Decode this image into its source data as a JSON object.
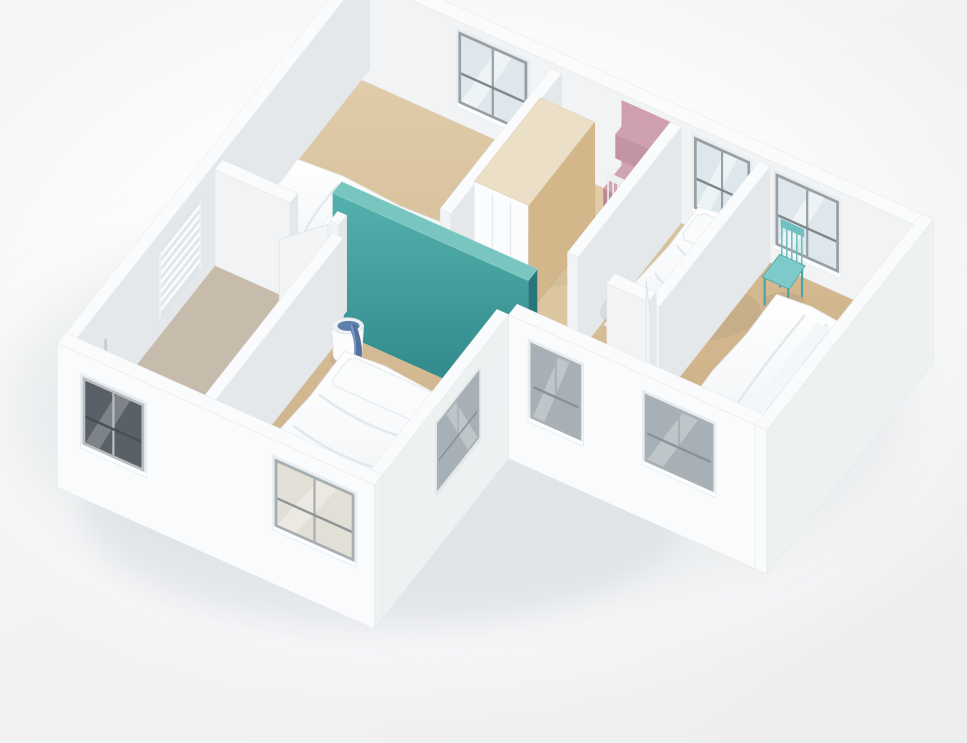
{
  "palette": {
    "background": "#f2f3f5",
    "wallTop": "#fafbfc",
    "wallFace": "#f1f3f5",
    "wallSide": "#e4e8ea",
    "wallExtFace": "#fafbfc",
    "wallExtSide": "#eef1f2",
    "wood": "#d5bb93",
    "woodDark": "#c7aa80",
    "bathroomFloor": "#c7bcab",
    "teal": "#3da2a0",
    "tealDark": "#27777a",
    "tealTop": "#79c5c0",
    "pink": "#cf9fae",
    "pinkDark": "#ab7684",
    "wardrobeWood": "#d4b68b",
    "bedWhite": "#ffffff",
    "chairTeal": "#7ec9c9",
    "chairTealLeg": "#4aa3a6",
    "chairWhite": "#f3f5f6",
    "laundryBlue": "#5d80ad",
    "glassLight": "#dde7ec",
    "glassMid": "#a6b0b6",
    "glassDark": "#596067",
    "frameGray": "#98a0a5",
    "shadow": "#d9dee1"
  },
  "scene": {
    "projection": {
      "origin": [
        358,
        64
      ],
      "u": [
        0.906,
        0.405
      ],
      "v": [
        -0.64,
        0.811
      ]
    },
    "objects": [
      {
        "name": "ground-shadow-far",
        "kind": "shadow",
        "cx": 300,
        "cy": 270,
        "rx": 450,
        "ry": 205,
        "fill": "#dde1e4",
        "op": 0.55,
        "blur": "f26"
      },
      {
        "name": "ground-shadow-near",
        "kind": "shadow",
        "cx": 310,
        "cy": 400,
        "rx": 300,
        "ry": 115,
        "fill": "#d3d8db",
        "op": 0.4,
        "blur": "f14"
      },
      {
        "name": "floor-main",
        "kind": "floorPoly",
        "fill": "wood",
        "pts": [
          [
            13,
            13
          ],
          [
            622,
            13
          ],
          [
            622,
            247
          ],
          [
            350,
            247
          ],
          [
            350,
            457
          ],
          [
            13,
            457
          ]
        ]
      },
      {
        "name": "floor-hall-tint",
        "kind": "floorPoly",
        "fill": "#ead9b6",
        "op": 0.3,
        "pts": [
          [
            234,
            13
          ],
          [
            354,
            13
          ],
          [
            354,
            230
          ],
          [
            234,
            230
          ]
        ]
      },
      {
        "name": "floor-bedroom3-tint",
        "kind": "floorPoly",
        "fill": "#cdab7e",
        "op": 0.35,
        "pts": [
          [
            452,
            13
          ],
          [
            622,
            13
          ],
          [
            622,
            247
          ],
          [
            452,
            247
          ]
        ]
      },
      {
        "name": "floor-bathroom",
        "kind": "floorPoly",
        "fill": "bath",
        "pts": [
          [
            13,
            230
          ],
          [
            150,
            230
          ],
          [
            150,
            457
          ],
          [
            13,
            457
          ]
        ]
      },
      {
        "name": "wall-north",
        "kind": "wall",
        "box": [
          0,
          0,
          635,
          13
        ],
        "h": 102,
        "windows": [
          {
            "face": "y",
            "x1": 120,
            "x2": 196,
            "z1": 20,
            "z2": 92,
            "style": "light"
          },
          {
            "face": "y",
            "x1": 380,
            "x2": 442,
            "z1": 20,
            "z2": 92,
            "style": "light"
          },
          {
            "face": "y",
            "x1": 470,
            "x2": 540,
            "z1": 20,
            "z2": 92,
            "style": "light"
          }
        ]
      },
      {
        "name": "wall-west",
        "kind": "wall",
        "box": [
          0,
          0,
          13,
          470
        ],
        "h": 102
      },
      {
        "name": "towel-radiator",
        "kind": "radiator",
        "y1": 262,
        "y2": 330
      },
      {
        "name": "shower-fixture",
        "kind": "shower",
        "y": 412
      },
      {
        "name": "bedroom1-bed",
        "kind": "bed",
        "rect": [
          34,
          140,
          186,
          206
        ],
        "axis": "u",
        "pillow": [
          150,
          146,
          180,
          200
        ]
      },
      {
        "name": "bedroom1-east-wall",
        "kind": "wall",
        "box": [
          222,
          13,
          234,
          186
        ],
        "h": 96
      },
      {
        "name": "wardrobe",
        "kind": "wardrobe",
        "box": [
          240,
          55,
          300,
          158
        ],
        "h": 108
      },
      {
        "name": "pink-desk-niche",
        "kind": "niche",
        "panel": [
          300,
          354
        ],
        "desk": [
          306,
          16,
          350,
          50
        ],
        "deskH": 40,
        "shelf": [
          308,
          14,
          348,
          34
        ],
        "shelfZ": [
          58,
          82
        ]
      },
      {
        "name": "desk-chair",
        "kind": "chair",
        "cx": 328,
        "cy": 70,
        "col": "white"
      },
      {
        "name": "hall-east-wall",
        "kind": "wall",
        "box": [
          354,
          13,
          366,
          174
        ],
        "h": 96
      },
      {
        "name": "bedroom2-bed",
        "kind": "bed",
        "rect": [
          392,
          20,
          446,
          158
        ],
        "axis": "v",
        "pillow": [
          396,
          26,
          442,
          58
        ]
      },
      {
        "name": "bedroom2-east-wall",
        "kind": "wall",
        "box": [
          452,
          13,
          464,
          186
        ],
        "h": 96
      },
      {
        "name": "bedroom2-south-wall",
        "kind": "wall",
        "box": [
          406,
          174,
          452,
          186
        ],
        "h": 96
      },
      {
        "name": "bedroom3-door",
        "kind": "leaf",
        "a": [
          458,
          192
        ],
        "b": [
          434,
          164
        ],
        "h": 92
      },
      {
        "name": "bedroom3-door-stub",
        "kind": "wall",
        "box": [
          452,
          240,
          464,
          247
        ],
        "h": 96
      },
      {
        "name": "hall-end-wall",
        "kind": "wall",
        "box": [
          136,
          234,
          150,
          256
        ],
        "h": 96
      },
      {
        "name": "teal-feature-wall",
        "kind": "tealWall",
        "box": [
          150,
          238,
          366,
          252
        ],
        "h": 136
      },
      {
        "name": "bathroom-north-wall",
        "kind": "wall",
        "box": [
          13,
          230,
          96,
          242
        ],
        "h": 96
      },
      {
        "name": "bathroom-north-stub",
        "kind": "wall",
        "box": [
          140,
          230,
          150,
          242
        ],
        "h": 96
      },
      {
        "name": "bathroom-door",
        "kind": "leaf",
        "a": [
          138,
          242
        ],
        "b": [
          108,
          276
        ],
        "h": 92
      },
      {
        "name": "bathroom-east-wall",
        "kind": "wall",
        "box": [
          150,
          252,
          162,
          457
        ],
        "h": 96
      },
      {
        "name": "laundry-basket",
        "kind": "basket",
        "cx": 182,
        "cy": 274
      },
      {
        "name": "bedroom4-bed",
        "kind": "bed",
        "rect": [
          196,
          296,
          324,
          452
        ],
        "axis": "v",
        "pillow": [
          204,
          300,
          316,
          334
        ]
      },
      {
        "name": "wall-notch-west",
        "kind": "wall",
        "box": [
          337,
          260,
          350,
          470
        ],
        "h": 102,
        "ext": true,
        "windows": [
          {
            "face": "x",
            "y1": 306,
            "y2": 372,
            "z1": 16,
            "z2": 84,
            "style": "mid"
          }
        ]
      },
      {
        "name": "bedroom3-chair",
        "kind": "chair",
        "cx": 500,
        "cy": 42,
        "col": "teal"
      },
      {
        "name": "bedroom3-bed",
        "kind": "bed",
        "rect": [
          512,
          68,
          620,
          208
        ],
        "axis": "u",
        "grayPillows": true
      },
      {
        "name": "wall-south-left",
        "kind": "wall",
        "box": [
          0,
          457,
          350,
          470
        ],
        "h": 102,
        "ext": true,
        "windows": [
          {
            "face": "y",
            "x1": 28,
            "x2": 96,
            "z1": 12,
            "z2": 80,
            "style": "dark"
          },
          {
            "face": "y",
            "x1": 240,
            "x2": 328,
            "z1": 16,
            "z2": 84,
            "style": "lightExt"
          }
        ]
      },
      {
        "name": "wall-south-right",
        "kind": "wall",
        "box": [
          350,
          247,
          635,
          260
        ],
        "h": 102,
        "ext": true,
        "windows": [
          {
            "face": "y",
            "x1": 374,
            "x2": 430,
            "z1": 8,
            "z2": 84,
            "style": "mid"
          },
          {
            "face": "y",
            "x1": 500,
            "x2": 576,
            "z1": 16,
            "z2": 84,
            "style": "mid"
          }
        ]
      },
      {
        "name": "wall-east",
        "kind": "wall",
        "box": [
          622,
          0,
          635,
          260
        ],
        "h": 102,
        "ext": true
      }
    ]
  }
}
